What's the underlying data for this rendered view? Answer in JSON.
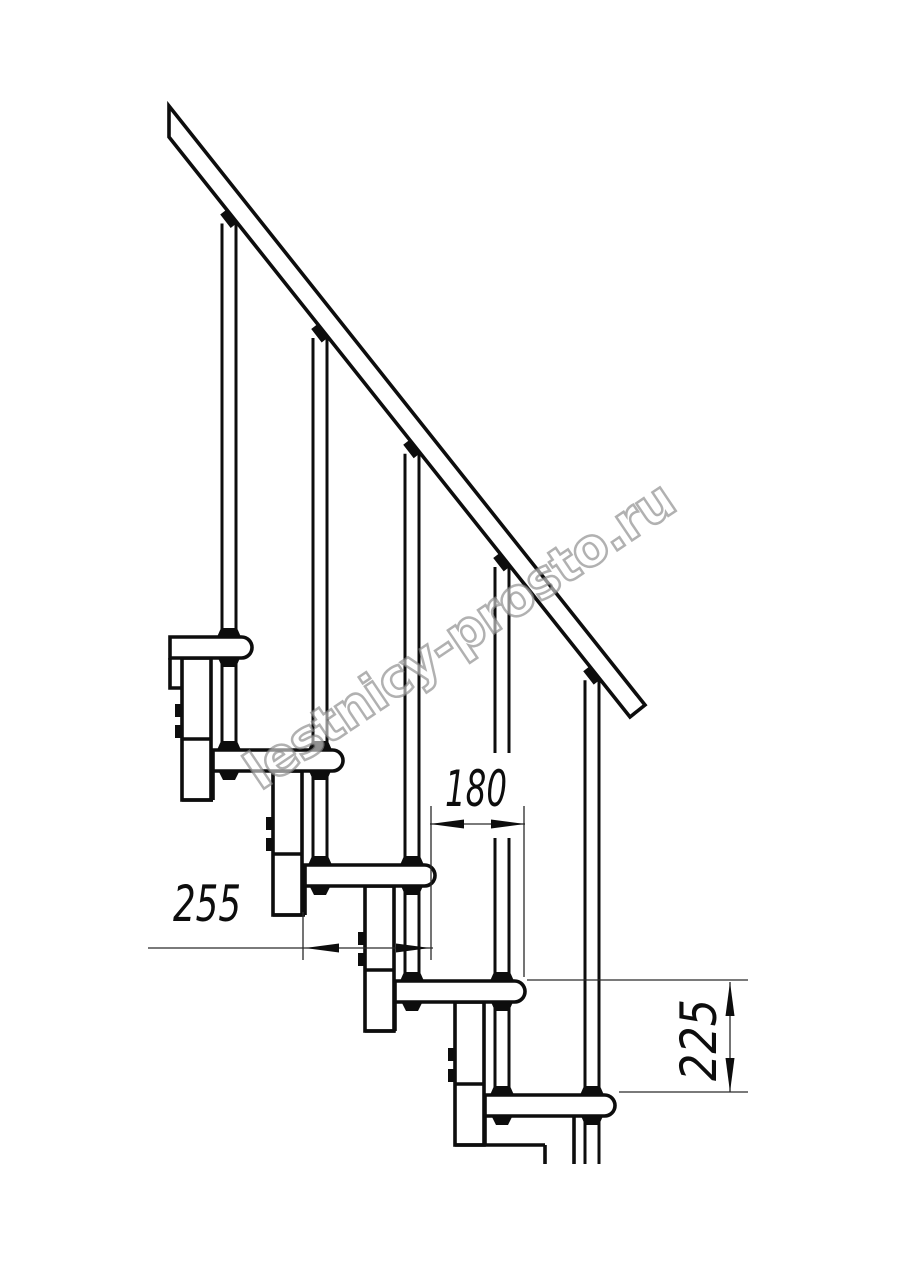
{
  "drawing": {
    "watermark": "lestnicy-prosto.ru",
    "labels": {
      "run": "180",
      "depth": "255",
      "rise": "225"
    },
    "line_color": "#0d0d0d",
    "watermark_color": "#8f8f8f",
    "background": "#ffffff",
    "geometry": {
      "canvas": [
        914,
        1280
      ],
      "tread_tops": [
        637,
        750,
        865,
        981,
        1095
      ],
      "tread_lefts": [
        170,
        213,
        305,
        395,
        485
      ],
      "pattern_lefts": [
        122,
        213,
        305,
        395,
        485
      ],
      "tread_width": 130,
      "tread_height": 21,
      "corner_radius": 10.5,
      "baluster_offset": 107,
      "rod_half_width": 7,
      "column_offset": 60,
      "column_width": 29,
      "rail": [
        [
          169,
          106
        ],
        [
          645,
          705
        ],
        [
          630,
          717
        ],
        [
          169,
          137
        ]
      ],
      "baluster_break": [
        753,
        838
      ],
      "bottom_cut_y": 1164,
      "dim_run": {
        "y": 824,
        "x1": 430,
        "x2": 525,
        "ext_top": 806
      },
      "dim_depth": {
        "y": 948,
        "x1": 305,
        "x2": 430,
        "tail_x": 148
      },
      "dim_rise": {
        "x": 730,
        "y1": 982,
        "y2": 1092,
        "ext_x2": 748
      }
    }
  }
}
